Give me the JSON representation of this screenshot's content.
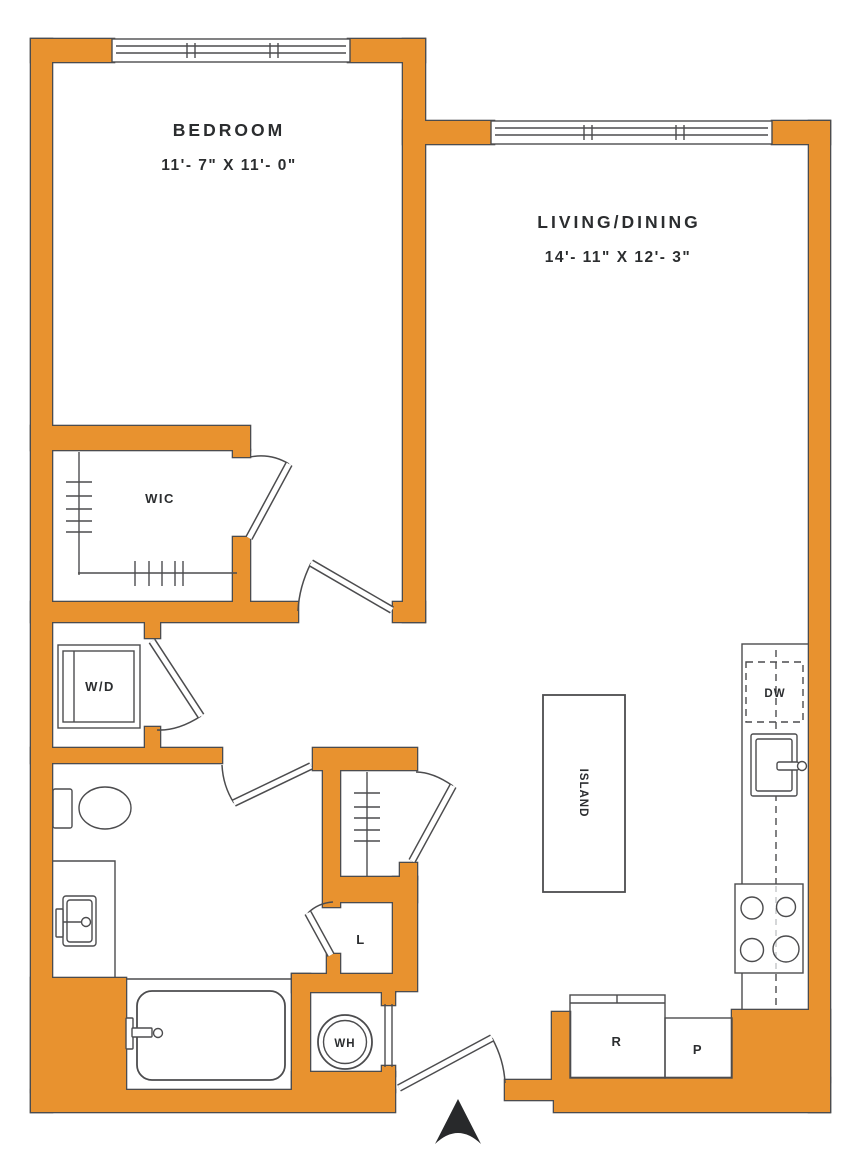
{
  "plan": {
    "rooms": {
      "bedroom": {
        "name": "BEDROOM",
        "dims": "11'- 7\" X 11'- 0\""
      },
      "living": {
        "name": "LIVING/DINING",
        "dims": "14'- 11\" X 12'- 3\""
      }
    },
    "labels": {
      "wic": "WIC",
      "washer_dryer": "W/D",
      "dishwasher": "DW",
      "island": "ISLAND",
      "linen": "L",
      "water_heater": "WH",
      "refrigerator": "R",
      "pantry": "P"
    },
    "colors": {
      "wall": "#E8922F",
      "line": "#4C4C4E",
      "text": "#2B2D2F",
      "background": "#FFFFFF"
    }
  }
}
